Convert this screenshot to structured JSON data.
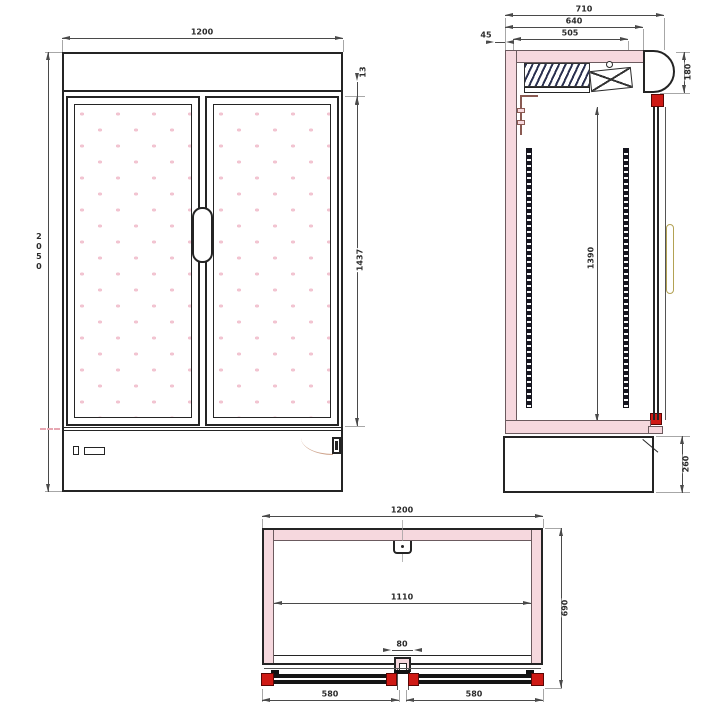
{
  "colors": {
    "line": "#242424",
    "dim_line": "#4a4a4a",
    "insulation_fill": "#f6d8de",
    "hinge_red": "#cf1a15",
    "glass_dot_pink": "#f2c4d1",
    "handle_gold": "#b3a254",
    "coil_navy": "#2b3150",
    "pipe_brown": "#8a5a52",
    "swing_arc_tan": "#cfa58e"
  },
  "front_view": {
    "dims": {
      "overall_width": "1200",
      "overall_height": "2050",
      "glass_door_height": "1437",
      "top_trim": "13"
    }
  },
  "side_view": {
    "dims": {
      "overall_depth": "710",
      "body_depth": "640",
      "interior_depth": "505",
      "back_clearance": "45",
      "canopy_height": "180",
      "interior_height": "1390",
      "base_height": "260"
    }
  },
  "plan_view": {
    "dims": {
      "overall_width": "1200",
      "interior_width": "1110",
      "center_mullion": "80",
      "left_door_width": "580",
      "right_door_width": "580",
      "overall_depth": "690"
    }
  }
}
